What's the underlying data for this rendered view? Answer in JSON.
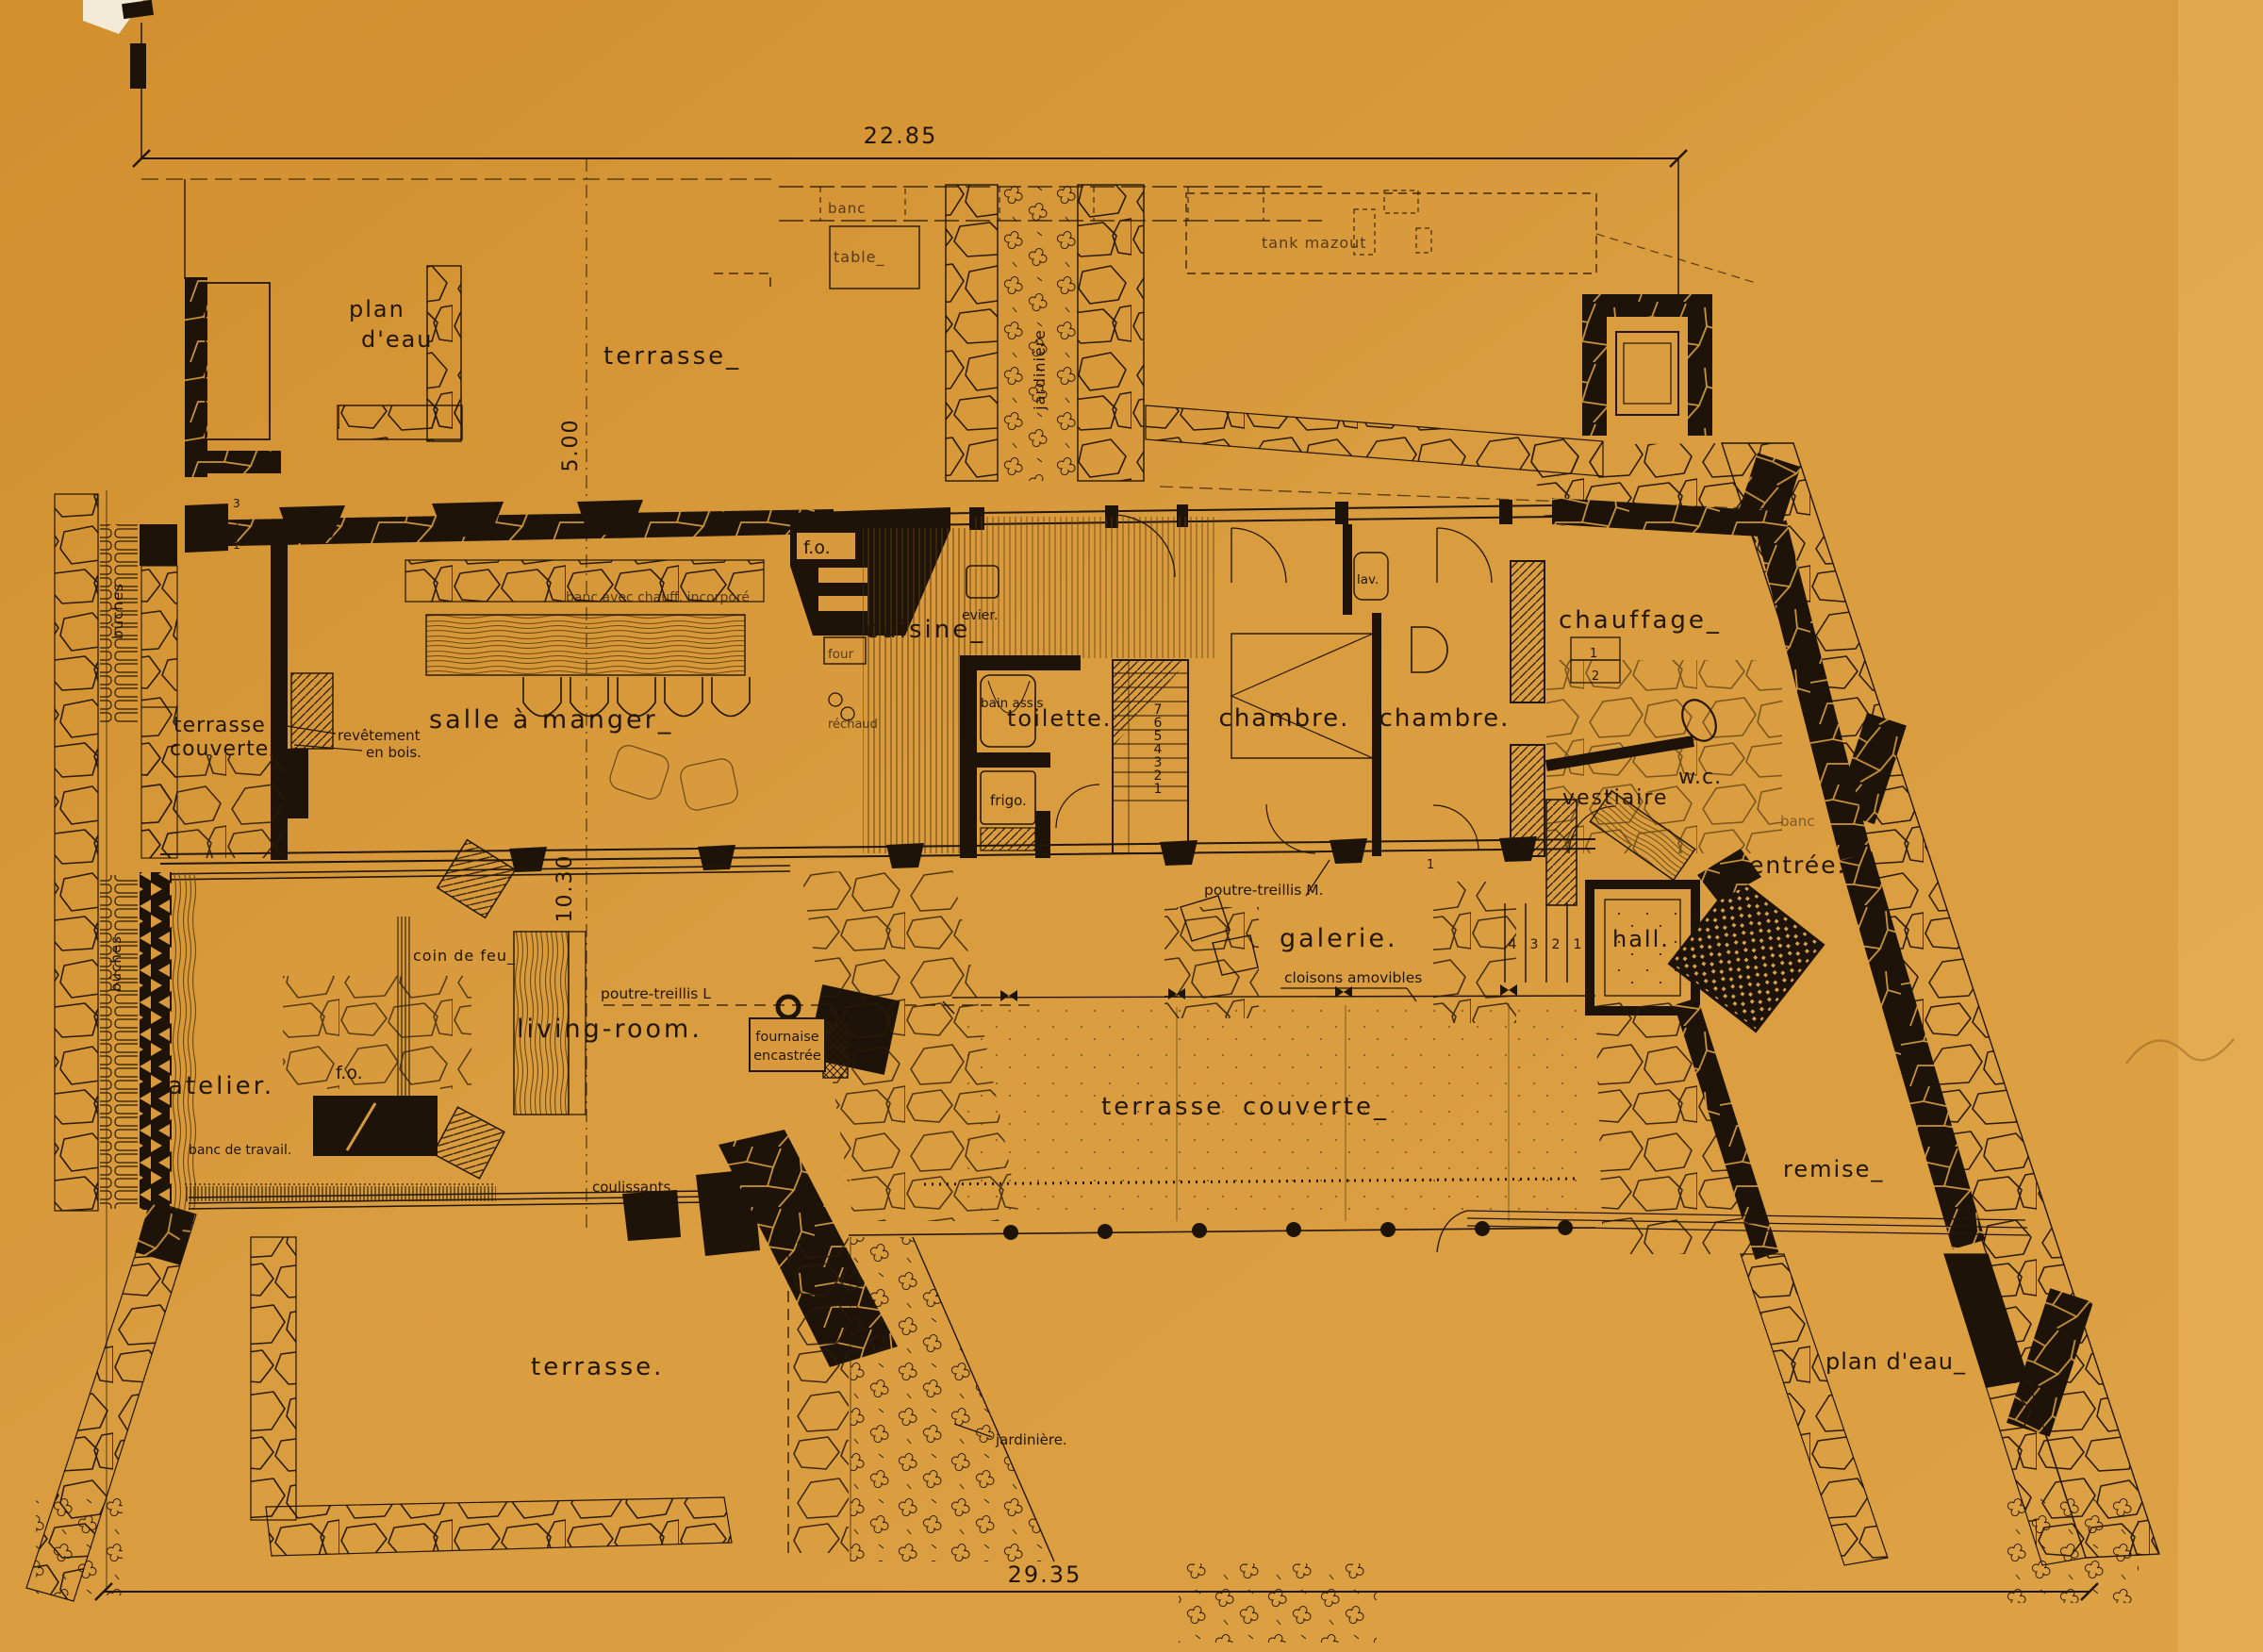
{
  "palette": {
    "paper": "#d89a3c",
    "paper_light": "#ecb65f",
    "ink": "#221607",
    "wall_black": "#1d1309",
    "wood": "#6e4a10"
  },
  "dimensions": {
    "top": "22.85",
    "upper": "5.00",
    "main": "10.30",
    "bottom": "29.35"
  },
  "rooms": {
    "plan_eau_top": [
      "plan",
      "d'eau"
    ],
    "terrasse_top": "terrasse_",
    "terrasse_couverte_left": [
      "terrasse",
      "couverte."
    ],
    "salle_a_manger": "salle à manger_",
    "cuisine": "cuisine_",
    "toilette": "toilette.",
    "chambre_a": "chambre.",
    "chambre_b": "chambre.",
    "chauffage": "chauffage_",
    "vestiaire": "vestiaire",
    "wc": "w.c.",
    "entree": "entrée.",
    "hall": "hall.",
    "galerie": "galerie.",
    "living_room": "living-room.",
    "atelier": "atelier.",
    "terrasse_couverte_mid": [
      "terrasse",
      "couverte_"
    ],
    "remise": "remise_",
    "terrasse_bottom": "terrasse.",
    "plan_eau_bottom": "plan d'eau_"
  },
  "annotations": {
    "banc_top": "banc",
    "table_top": "table_",
    "jardiniere_top": "jardinière",
    "tank_mazout": "tank mazout",
    "buches_upper": "bûches",
    "buches_lower": "bûches",
    "revetement": [
      "revêtement",
      "en bois."
    ],
    "banc_chauff": "banc avec chauff. incorporé",
    "fo_cuisine": "f.o.",
    "fo_atelier": "f.o.",
    "fo_terrasse": "f.o.",
    "evier": "evier.",
    "four": "four",
    "rechaud": "réchaud",
    "bain_assis": "bain assis",
    "frigo": "frigo.",
    "lav": "lav.",
    "banc_entree": "banc",
    "poutre_m": "poutre-treillis M.",
    "cloisons": "cloisons amovibles",
    "poutre_l": "poutre-treillis L",
    "fournaise": [
      "fournaise",
      "encastrée"
    ],
    "coin_de_feu": "coin de feu_",
    "banc_travail": "banc de travail.",
    "coulissants": "coulissants.",
    "jardiniere_bottom": "jardinière."
  },
  "stairs": {
    "main": [
      "7",
      "6",
      "5",
      "4",
      "3",
      "2",
      "1"
    ],
    "hall": [
      "4",
      "3",
      "2",
      "1"
    ],
    "chauffage": [
      "1",
      "2"
    ],
    "left": [
      "3",
      "2",
      "1"
    ],
    "wall_mark": "1"
  }
}
